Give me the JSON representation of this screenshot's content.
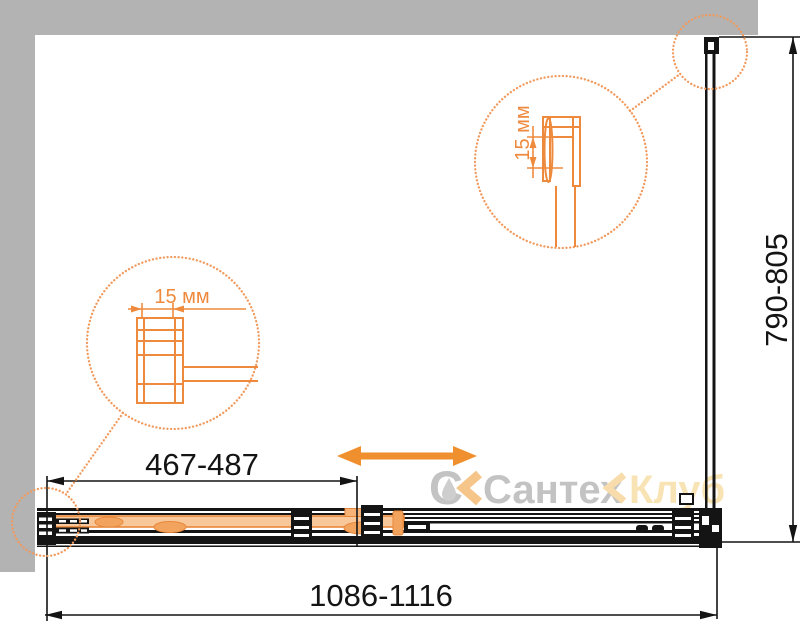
{
  "dimensions": {
    "door_adjustment": "467-487",
    "overall_width": "1086-1116",
    "side_panel_depth": "790-805",
    "detail_top_label": "15 мм",
    "detail_left_label": "15 мм"
  },
  "watermark": {
    "logo_letter": "С",
    "brand": "Сантех",
    "club": "Клуб"
  },
  "icons": {
    "slide_direction": "double-headed-arrow-icon",
    "detail_callout": "magnifier-dotted-circle-icon",
    "watermark_logo": "water-drop-icon"
  },
  "colors": {
    "wall_gray": "#b3b3b3",
    "drawing_black": "#141414",
    "accent_orange": "#ee8a3d",
    "callout_dotted_orange": "#f09a5e",
    "door_glass_fill": "#f9c89a",
    "roller_orange": "#f2a45f",
    "watermark_gray": "#bdbdbd",
    "watermark_chevron_orange": "#f5bf7e",
    "watermark_pale": "#f8e0ae"
  }
}
